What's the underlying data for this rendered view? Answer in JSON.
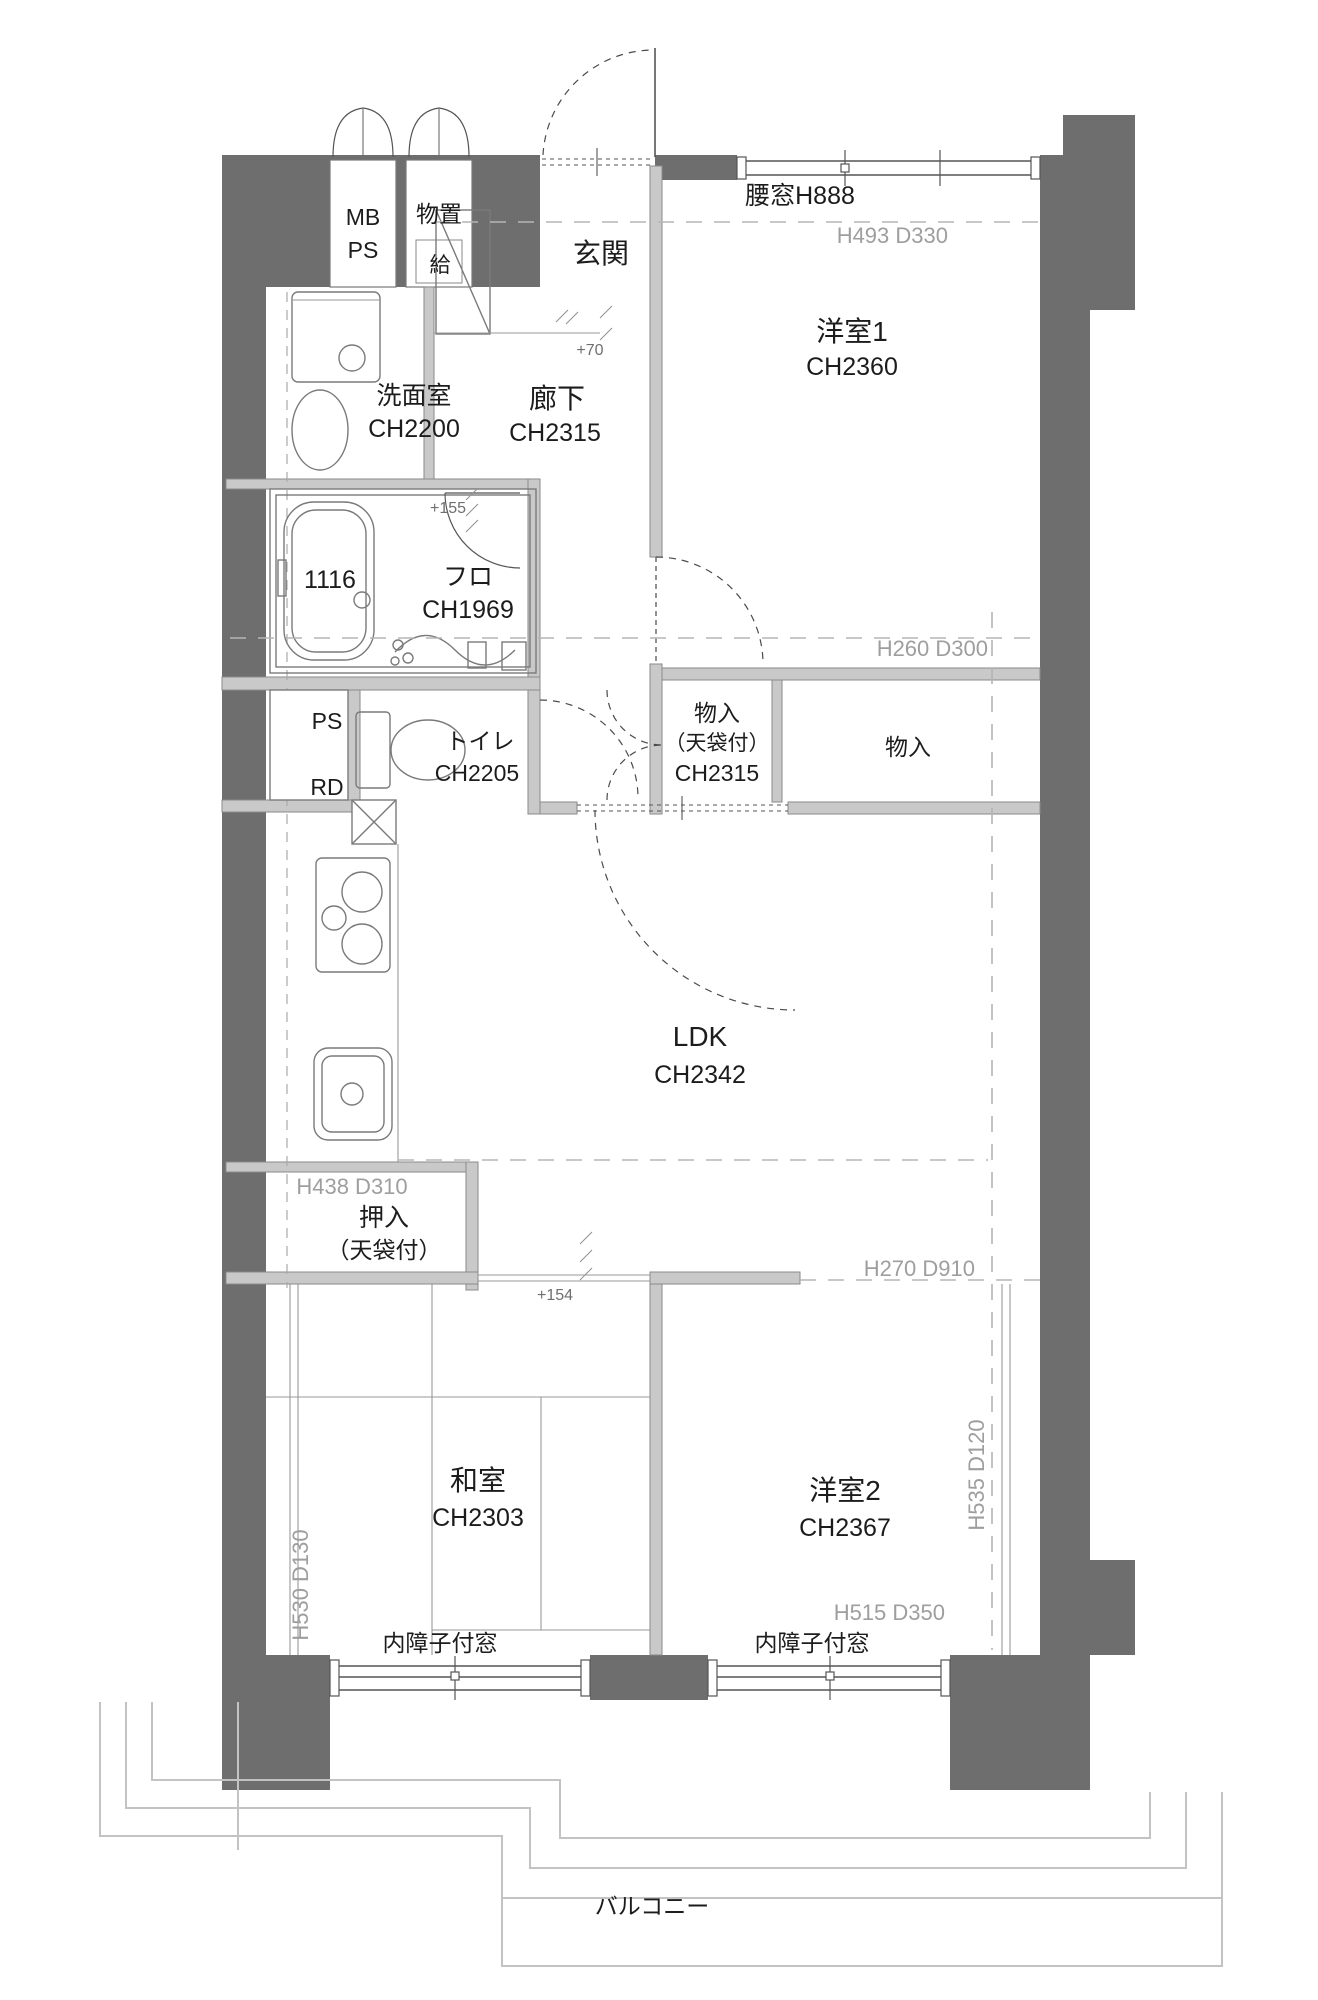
{
  "plan": {
    "colors": {
      "wall": "#6e6e6e",
      "partition": "#c9c9c9",
      "dim_text": "#9e9e9e",
      "text": "#1c1c1c"
    },
    "rooms": {
      "mb_ps": {
        "line1": "MB",
        "line2": "PS"
      },
      "monooki": {
        "label": "物置"
      },
      "kyu": {
        "label": "給"
      },
      "genkan": {
        "label": "玄関"
      },
      "senmenshitsu": {
        "label": "洗面室",
        "ch": "CH2200"
      },
      "furo": {
        "label": "フロ",
        "ch": "CH1969",
        "tub_size": "1116"
      },
      "rouka": {
        "label": "廊下",
        "ch": "CH2315"
      },
      "yoshitsu1": {
        "label": "洋室1",
        "ch": "CH2360"
      },
      "toilet": {
        "label": "トイレ",
        "ch": "CH2205"
      },
      "ps": {
        "label": "PS"
      },
      "rd": {
        "label": "RD"
      },
      "monoiri_tenbukuro": {
        "line1": "物入",
        "line2": "（天袋付）",
        "ch": "CH2315"
      },
      "monoiri": {
        "label": "物入"
      },
      "ldk": {
        "label": "LDK",
        "ch": "CH2342"
      },
      "oshiire": {
        "line1": "押入",
        "line2": "（天袋付）"
      },
      "washitsu": {
        "label": "和室",
        "ch": "CH2303"
      },
      "yoshitsu2": {
        "label": "洋室2",
        "ch": "CH2367"
      },
      "balcony": {
        "label": "バルコニー"
      }
    },
    "windows": {
      "koshimado": {
        "label": "腰窓H888"
      },
      "uchishoji_left": {
        "label": "内障子付窓"
      },
      "uchishoji_right": {
        "label": "内障子付窓"
      }
    },
    "dimensions": {
      "h493_d330": "H493 D330",
      "h260_d300": "H260 D300",
      "h438_d310": "H438 D310",
      "h270_d910": "H270 D910",
      "h530_d130": "H530 D130",
      "h535_d120": "H535 D120",
      "h515_d350": "H515 D350"
    },
    "floor_levels": {
      "genkan_step": "+70",
      "furo_step": "+155",
      "washitsu_step": "+154"
    }
  }
}
